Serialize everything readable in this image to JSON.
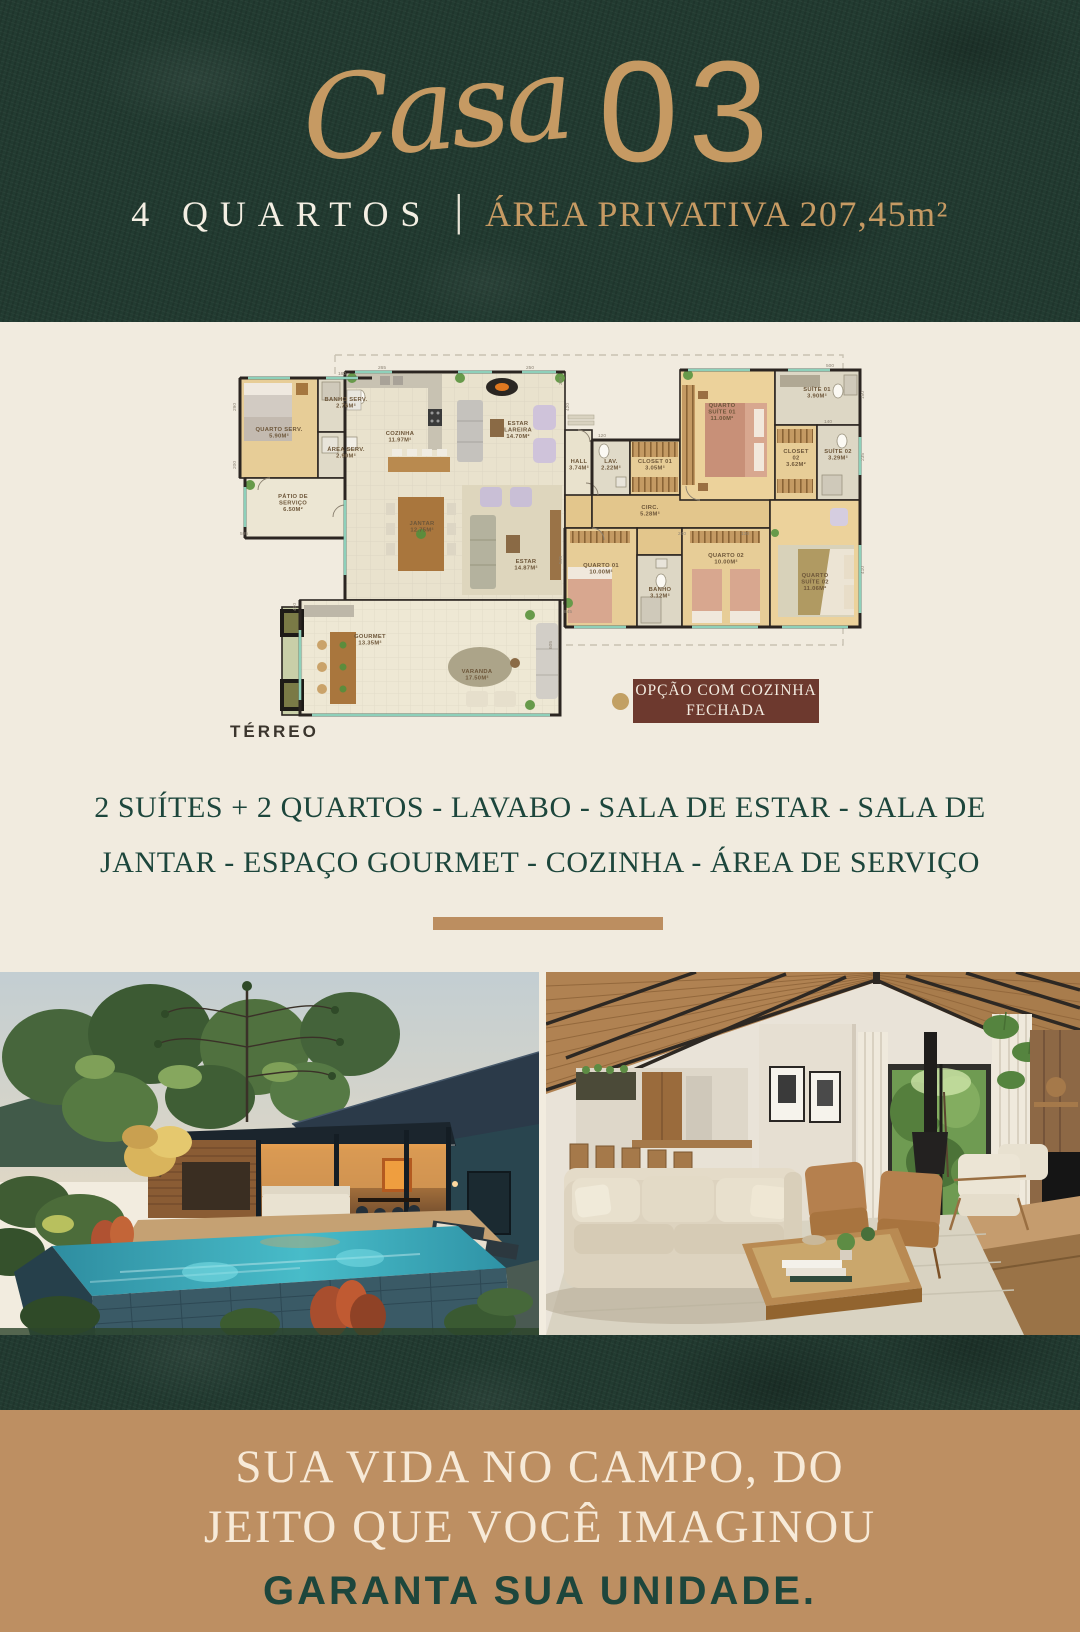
{
  "header": {
    "script_word": "Casa",
    "number": "03",
    "bedrooms": "4 QUARTOS",
    "separator": "|",
    "area_label": "ÁREA PRIVATIVA 207,45m²"
  },
  "floorplan": {
    "level_label": "TÉRREO",
    "badge": {
      "lines": [
        "OPÇÃO COM COZINHA",
        "FECHADA"
      ]
    },
    "rooms": [
      {
        "id": "quarto-serv",
        "x": 49,
        "y": 86,
        "lines": [
          "QUARTO SERV.",
          "5.90M²"
        ]
      },
      {
        "id": "banho-serv",
        "x": 116,
        "y": 56,
        "lines": [
          "BANHO SERV.",
          "2.76M²"
        ]
      },
      {
        "id": "area-serv",
        "x": 116,
        "y": 106,
        "lines": [
          "ÁREA SERV.",
          "2.90M²"
        ]
      },
      {
        "id": "patio-servico",
        "x": 63,
        "y": 153,
        "lines": [
          "PÁTIO DE",
          "SERVIÇO",
          "6.50M²"
        ]
      },
      {
        "id": "cozinha",
        "x": 170,
        "y": 90,
        "lines": [
          "COZINHA",
          "11.97M²"
        ]
      },
      {
        "id": "estar-lareira",
        "x": 288,
        "y": 80,
        "lines": [
          "ESTAR",
          "LAREIRA",
          "14.70M²"
        ]
      },
      {
        "id": "jantar",
        "x": 192,
        "y": 180,
        "lines": [
          "JANTAR",
          "12.75M²"
        ]
      },
      {
        "id": "estar",
        "x": 296,
        "y": 218,
        "lines": [
          "ESTAR",
          "14.87M²"
        ]
      },
      {
        "id": "hall",
        "x": 349,
        "y": 118,
        "lines": [
          "HALL",
          "3.74M²"
        ]
      },
      {
        "id": "lav",
        "x": 381,
        "y": 118,
        "lines": [
          "LAV.",
          "2.22M²"
        ]
      },
      {
        "id": "closet-01",
        "x": 425,
        "y": 118,
        "lines": [
          "CLOSET 01",
          "3.05M²"
        ]
      },
      {
        "id": "circ",
        "x": 420,
        "y": 164,
        "lines": [
          "CIRC.",
          "5.28M²"
        ]
      },
      {
        "id": "quarto-suite-01",
        "x": 492,
        "y": 62,
        "lines": [
          "QUARTO",
          "SUÍTE 01",
          "11.00M²"
        ]
      },
      {
        "id": "suite-01",
        "x": 587,
        "y": 46,
        "lines": [
          "SUÍTE 01",
          "3.90M²"
        ]
      },
      {
        "id": "closet-02",
        "x": 566,
        "y": 108,
        "lines": [
          "CLOSET",
          "02",
          "3.62M²"
        ]
      },
      {
        "id": "suite-02",
        "x": 608,
        "y": 108,
        "lines": [
          "SUÍTE 02",
          "3.29M²"
        ]
      },
      {
        "id": "quarto-01",
        "x": 371,
        "y": 222,
        "lines": [
          "QUARTO 01",
          "10.00M²"
        ]
      },
      {
        "id": "banho",
        "x": 430,
        "y": 246,
        "lines": [
          "BANHO",
          "3.12M²"
        ]
      },
      {
        "id": "quarto-02",
        "x": 496,
        "y": 212,
        "lines": [
          "QUARTO 02",
          "10.00M²"
        ]
      },
      {
        "id": "quarto-suite-02",
        "x": 585,
        "y": 232,
        "lines": [
          "QUARTO",
          "SUÍTE 02",
          "11.06M²"
        ]
      },
      {
        "id": "gourmet",
        "x": 140,
        "y": 293,
        "lines": [
          "GOURMET",
          "13.35M²"
        ]
      },
      {
        "id": "varanda",
        "x": 247,
        "y": 328,
        "lines": [
          "VARANDA",
          "17.50M²"
        ]
      }
    ],
    "dims": [
      {
        "v": "290",
        "x": 6,
        "y": 62,
        "r": -90
      },
      {
        "v": "160",
        "x": 112,
        "y": 30
      },
      {
        "v": "265",
        "x": 152,
        "y": 24
      },
      {
        "v": "250",
        "x": 300,
        "y": 24
      },
      {
        "v": "350",
        "x": 332,
        "y": 36,
        "r": -90
      },
      {
        "v": "420",
        "x": 339,
        "y": 62,
        "r": -90
      },
      {
        "v": "200",
        "x": 6,
        "y": 120,
        "r": -90
      },
      {
        "v": "595",
        "x": 14,
        "y": 190
      },
      {
        "v": "500",
        "x": 600,
        "y": 22
      },
      {
        "v": "150",
        "x": 634,
        "y": 50,
        "r": -90
      },
      {
        "v": "140",
        "x": 598,
        "y": 78
      },
      {
        "v": "235",
        "x": 634,
        "y": 112,
        "r": -90
      },
      {
        "v": "120",
        "x": 372,
        "y": 92
      },
      {
        "v": "545",
        "x": 332,
        "y": 215,
        "r": -90
      },
      {
        "v": "240",
        "x": 452,
        "y": 190
      },
      {
        "v": "130",
        "x": 515,
        "y": 190
      },
      {
        "v": "410",
        "x": 634,
        "y": 225,
        "r": -90
      },
      {
        "v": "605",
        "x": 322,
        "y": 300,
        "r": -90
      },
      {
        "v": "845",
        "x": 338,
        "y": 268
      },
      {
        "v": "400",
        "x": 66,
        "y": 262,
        "r": -90
      }
    ]
  },
  "features": {
    "lines": [
      "2 SUÍTES + 2 QUARTOS - LAVABO - SALA DE ESTAR - SALA DE",
      "JANTAR - ESPAÇO GOURMET - COZINHA - ÁREA DE SERVIÇO"
    ]
  },
  "photos": {
    "left": "exterior-pool-at-dusk-render",
    "right": "interior-living-room-render"
  },
  "footer": {
    "headline_lines": [
      "SUA VIDA NO CAMPO, DO",
      "JEITO QUE VOCÊ IMAGINOU"
    ],
    "cta": "GARANTA SUA UNIDADE."
  },
  "colors": {
    "deep_green": "#223b31",
    "gold": "#c69a63",
    "cream": "#f1ebdf",
    "tan_band": "#bd8f62",
    "badge_brown": "#6d392e",
    "text_green": "#1d463c",
    "plan_wall": "#2b2521",
    "plan_window": "#8ed0ba"
  }
}
